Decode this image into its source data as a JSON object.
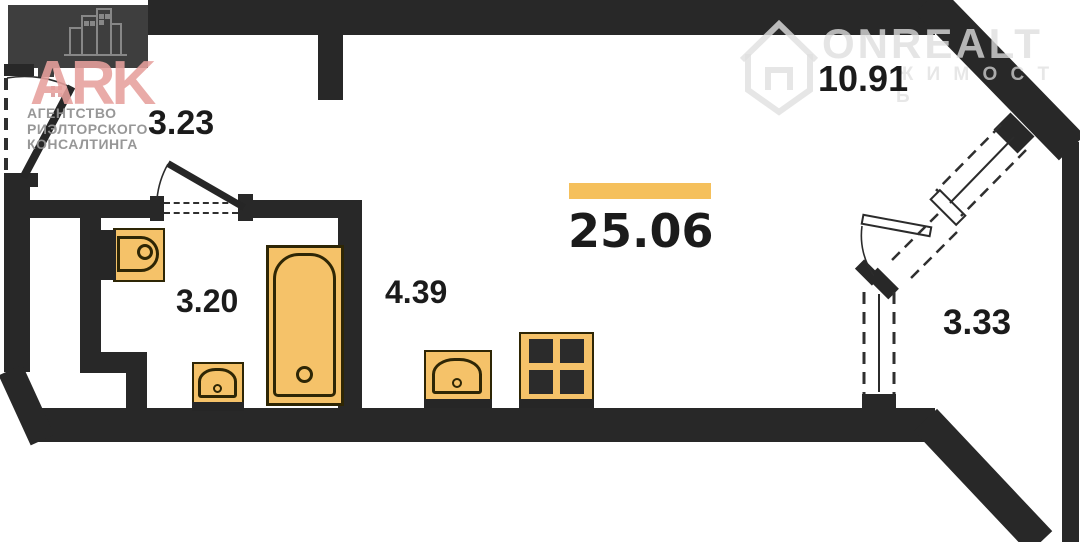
{
  "plan": {
    "rooms": [
      {
        "id": "hall",
        "area": "3.23"
      },
      {
        "id": "bathroom",
        "area": "3.20"
      },
      {
        "id": "kitchen-zone",
        "area": "4.39"
      },
      {
        "id": "living-room",
        "area": "10.91"
      },
      {
        "id": "balcony",
        "area": "3.33"
      }
    ],
    "total_area": "25.06",
    "fixtures": [
      "toilet",
      "bathtub",
      "bathroom-sink",
      "kitchen-sink",
      "stove"
    ]
  },
  "watermarks": {
    "ark": {
      "letters": "ARK",
      "line1": "АГЕНТСТВО",
      "line2": "РИЭЛТОРСКОГО",
      "line3": "КОНСАЛТИНГА",
      "letters_color": "#E7A09D",
      "text_color": "#929292"
    },
    "onrealt": {
      "brand": "ONREALT",
      "sub": "Ж И М О С Т Ь",
      "color": "#DEDEDE"
    }
  },
  "colors": {
    "wall": "#282828",
    "gray_block": "#3E3E3E",
    "fixture_fill": "#F5C269",
    "fixture_stroke": "#2e2605",
    "accent_bar": "#F5C05C",
    "label_text": "#1b1b1b"
  }
}
